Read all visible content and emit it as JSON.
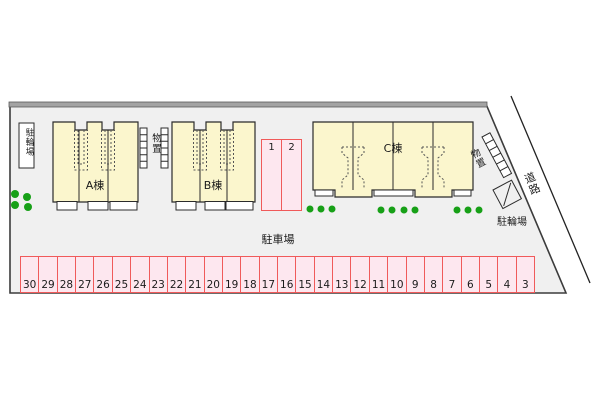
{
  "plan": {
    "buildings": [
      {
        "label": "A棟"
      },
      {
        "label": "B棟"
      },
      {
        "label": "C棟"
      }
    ],
    "labels": {
      "bicycle_parking_left": "駐輪場",
      "bicycle_parking_right": "駐輪場",
      "storage_between": "物置",
      "storage_right": "物置",
      "road": "道路",
      "car_parking": "駐車場"
    },
    "parking": {
      "front_spaces": [
        "1",
        "2"
      ],
      "main_spaces": [
        "30",
        "29",
        "28",
        "27",
        "26",
        "25",
        "24",
        "23",
        "22",
        "21",
        "20",
        "19",
        "18",
        "17",
        "16",
        "15",
        "14",
        "13",
        "12",
        "11",
        "10",
        "9",
        "8",
        "7",
        "6",
        "5",
        "4",
        "3"
      ]
    },
    "colors": {
      "site_ground": "#f0f0f0",
      "building_fill": "#fbf6cd",
      "parking_fill": "#fde7ef",
      "parking_border": "#f05a5a",
      "greenery": "#17a017",
      "boundary_band": "#a3a3a3"
    }
  }
}
